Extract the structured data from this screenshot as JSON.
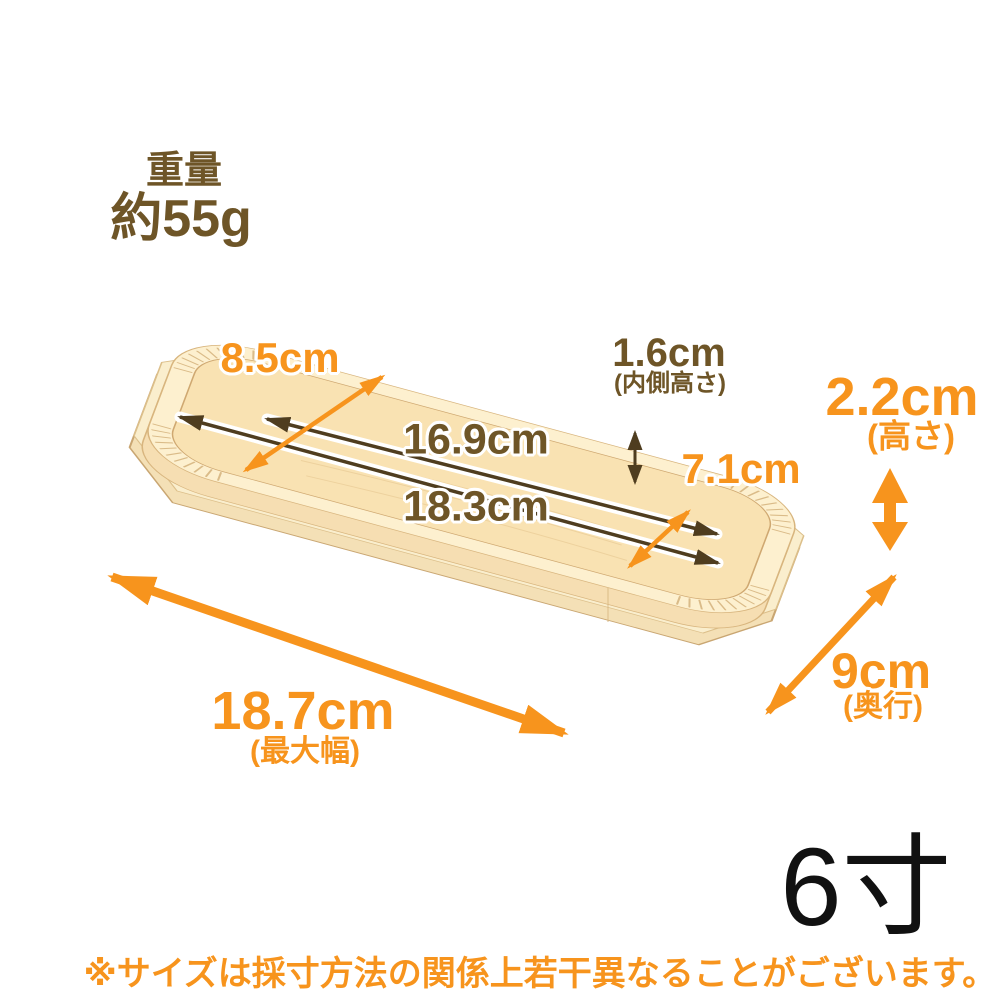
{
  "product": {
    "weight": {
      "label": "重量",
      "value": "約55g"
    },
    "size_label": "6寸",
    "disclaimer": "※サイズは採寸方法の関係上若干異なることがございます。",
    "dimensions": {
      "top_width": {
        "value": "8.5cm"
      },
      "inner_length": {
        "value": "16.9cm"
      },
      "outer_length": {
        "value": "18.3cm"
      },
      "inner_height": {
        "value": "1.6cm",
        "note": "(内側高さ)"
      },
      "inner_width": {
        "value": "7.1cm"
      },
      "height": {
        "value": "2.2cm",
        "note": "(高さ)"
      },
      "depth": {
        "value": "9cm",
        "note": "(奥行)"
      },
      "max_width": {
        "value": "18.7cm",
        "note": "(最大幅)"
      }
    }
  },
  "colors": {
    "accent_orange": "#f7941d",
    "text_brown": "#6e5527",
    "arrow_brown": "#4f3d1f",
    "wood_light": "#fdf0cf",
    "wood_mid": "#f4dcae",
    "wood_dark": "#e8cd9e",
    "size_text": "#111111"
  }
}
